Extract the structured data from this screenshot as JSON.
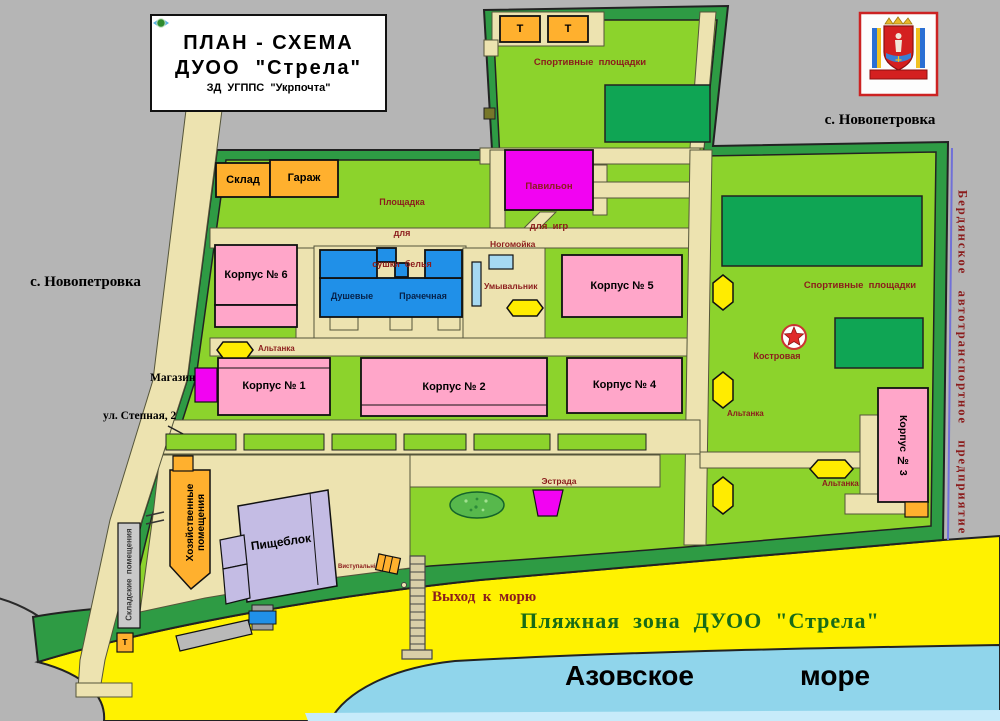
{
  "sign": {
    "line1": "ПЛАН - СХЕМА",
    "line2": "ДУОО  \"Стрела\"",
    "org": "ЗД  УГППС  \"Укрпочта\""
  },
  "villages": {
    "left": "с. Новопетровка",
    "top_right": "с. Новопетровка"
  },
  "outside": {
    "transport_company": "Бердянское   автотранспортное   предприятие"
  },
  "areas": {
    "sport": "Спортивные  площадки",
    "drying_1": "Площадка",
    "drying_2": "для",
    "drying_3": "сушки  белья",
    "street": "ул. Степная, 2",
    "exit_to_sea": "Выход  к  морю",
    "beach": "Пляжная  зона  ДУОО  \"Стрела\"",
    "sea_word_1": "Азовское",
    "sea_word_2": "море"
  },
  "buildings": {
    "sklad": "Склад",
    "garage": "Гараж",
    "pavilion_1": "Павильон",
    "pavilion_2": "для  игр",
    "k1": "Корпус № 1",
    "k2": "Корпус № 2",
    "k3": "Корпус № 3",
    "k4": "Корпус № 4",
    "k5": "Корпус № 5",
    "k6": "Корпус № 6",
    "shower": "Душевые",
    "laundry": "Прачечная",
    "footwash": "Ногомойка",
    "washstand": "Умывальник",
    "shop": "Магазин",
    "household_1": "Хозяйственные",
    "household_2": "помещения",
    "storage": "Складские  помещения",
    "canteen": "Пищеблок",
    "stage": "Эстрада",
    "campfire": "Костровая",
    "gazebo": "Альтанка",
    "toilet": "Т",
    "small_note": "Виступальні"
  },
  "colors": {
    "village_gray": "#b5b5b5",
    "camp_green": "#8cd32c",
    "hedge_green": "#2e9b44",
    "field_green": "#0fa554",
    "path_beige": "#ede3b0",
    "building_pink": "#ffa6c9",
    "building_orange": "#ffb02e",
    "building_magenta": "#f203f2",
    "building_blue": "#2090e8",
    "light_blue": "#a6d9f2",
    "canteen_lavender": "#c4bce4",
    "gazebo_yellow": "#ffec00",
    "beach_yellow": "#fff200",
    "sea_blue": "#90d5eb",
    "label_red": "#8b1c1c",
    "beach_text_green": "#176b17"
  }
}
